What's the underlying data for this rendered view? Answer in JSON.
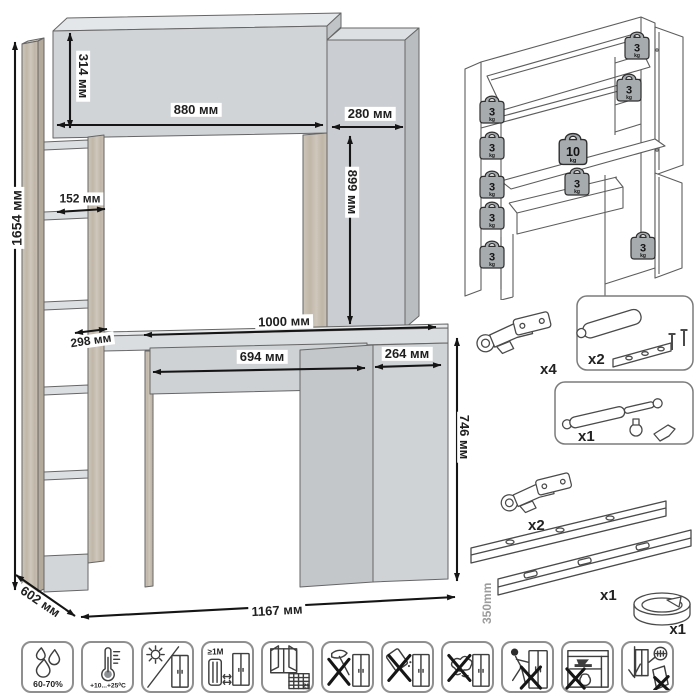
{
  "dimensions": {
    "total_height": "1654 мм",
    "hutch_height": "314 мм",
    "hutch_width": "880 мм",
    "top_cabinet_width": "280 мм",
    "top_cabinet_height": "899 мм",
    "upper_shelf_depth": "152 мм",
    "lower_shelf_depth": "298 мм",
    "desktop_width": "1000 мм",
    "drawer_width": "694 мм",
    "door_width": "264 мм",
    "desk_height": "746 мм",
    "depth": "602 мм",
    "total_width": "1167 мм"
  },
  "load_capacity": {
    "unit": "kg",
    "weights": [
      {
        "location": "left-shelf-1",
        "value": "3"
      },
      {
        "location": "left-shelf-2",
        "value": "3"
      },
      {
        "location": "left-shelf-3",
        "value": "3"
      },
      {
        "location": "left-shelf-4",
        "value": "3"
      },
      {
        "location": "left-shelf-5",
        "value": "3"
      },
      {
        "location": "hutch-right-top",
        "value": "3"
      },
      {
        "location": "hutch-right-shelf",
        "value": "3"
      },
      {
        "location": "desktop",
        "value": "10"
      },
      {
        "location": "drawer",
        "value": "3"
      },
      {
        "location": "pedestal-cabinet",
        "value": "3"
      }
    ]
  },
  "hardware": {
    "hinges_top": {
      "qty": "x4"
    },
    "dampers": {
      "qty": "x2"
    },
    "gas_lift": {
      "qty": "x1"
    },
    "hinges_bottom": {
      "qty": "x2"
    },
    "drawer_slides": {
      "qty": "x1",
      "length": "350mm"
    },
    "cable_grommet": {
      "qty": "x1"
    }
  },
  "care_icons": {
    "humidity": {
      "label": "60-70%"
    },
    "temperature": {
      "label": "+10...+25⁰С"
    },
    "radiator_distance": {
      "label": "≥1М"
    },
    "ventilation": {
      "calendar_day": "21"
    }
  },
  "colors": {
    "furniture_gray": "#ced2d5",
    "wood": "#c8c0b4",
    "outline": "#666666",
    "arrow": "#151515",
    "weight_fill": "#a6abae"
  }
}
